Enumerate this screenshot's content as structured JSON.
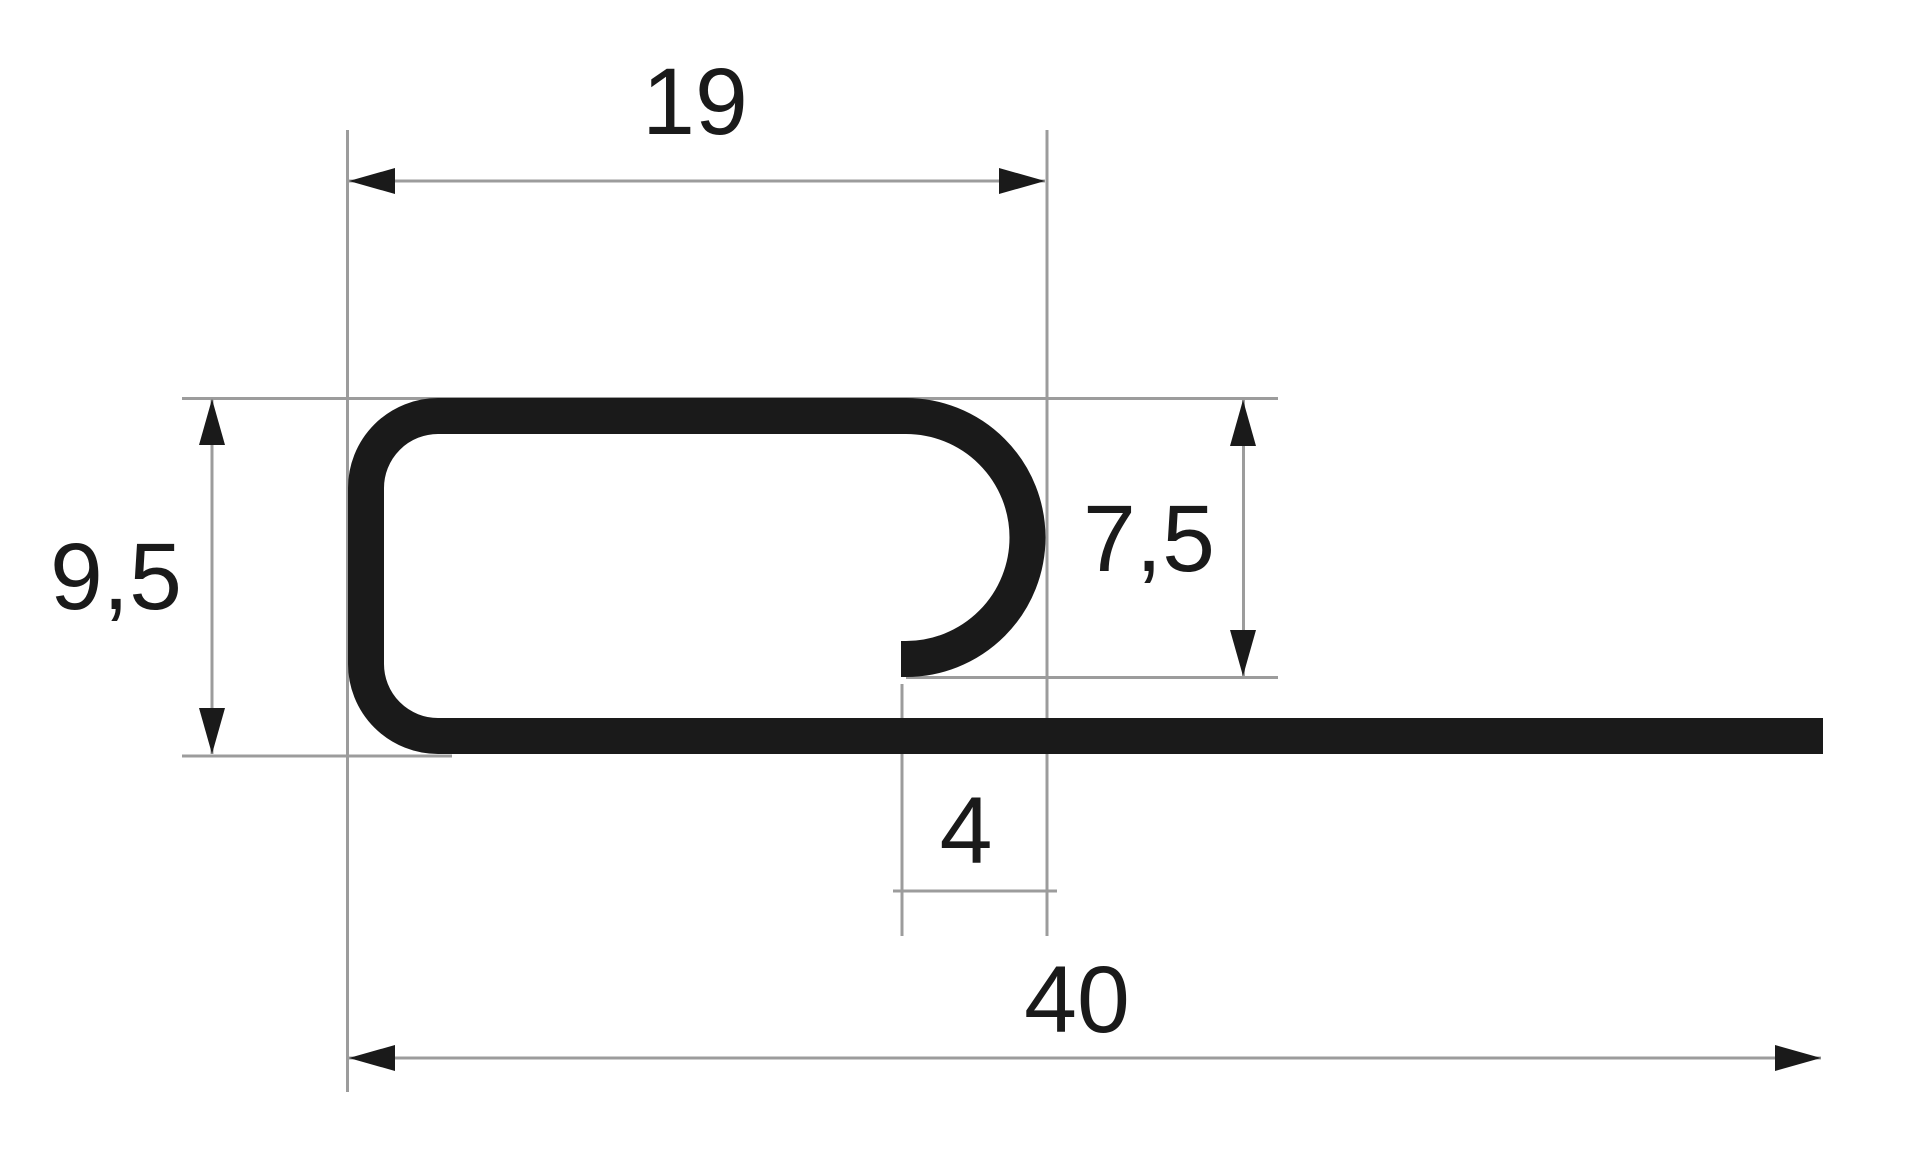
{
  "colors": {
    "ink": "#1a1a1a",
    "construction_line": "#9c9c9c",
    "background": "#ffffff"
  },
  "drawing": {
    "kind": "profile-cross-section",
    "dimensions": {
      "top_width": {
        "label": "19",
        "value": 19
      },
      "left_height": {
        "label": "9,5",
        "value": 9.5
      },
      "curl_depth": {
        "label": "7,5",
        "value": 7.5
      },
      "curl_opening": {
        "label": "4",
        "value": 4
      },
      "base_width": {
        "label": "40",
        "value": 40
      }
    }
  }
}
